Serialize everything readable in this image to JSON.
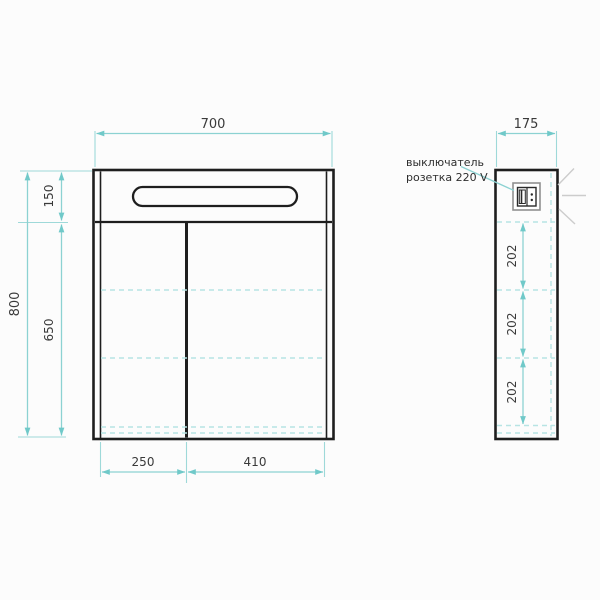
{
  "drawing": {
    "front_view": {
      "width_label": "700",
      "total_height_label": "800",
      "light_section_height_label": "150",
      "body_height_label": "650",
      "left_door_width_label": "250",
      "right_door_width_label": "410"
    },
    "side_view": {
      "depth_label": "175",
      "shelf_spacing_labels": [
        "202",
        "202",
        "202"
      ],
      "annotation": {
        "line1": "выключатель",
        "line2": "розетка 220 V"
      }
    },
    "icons": {
      "switch_socket": "switch-socket-220v-symbol",
      "light_rays": "light-emission-rays"
    },
    "colors": {
      "outline": "#1e1e1e",
      "dimension_teal": "#8cd2d2",
      "arrow_teal": "#70c9c9",
      "dashed_teal": "#b7e4e4",
      "label_text": "#3a3a3a",
      "light_ray_grey": "#cccccc",
      "background": "#fcfcfc"
    }
  }
}
